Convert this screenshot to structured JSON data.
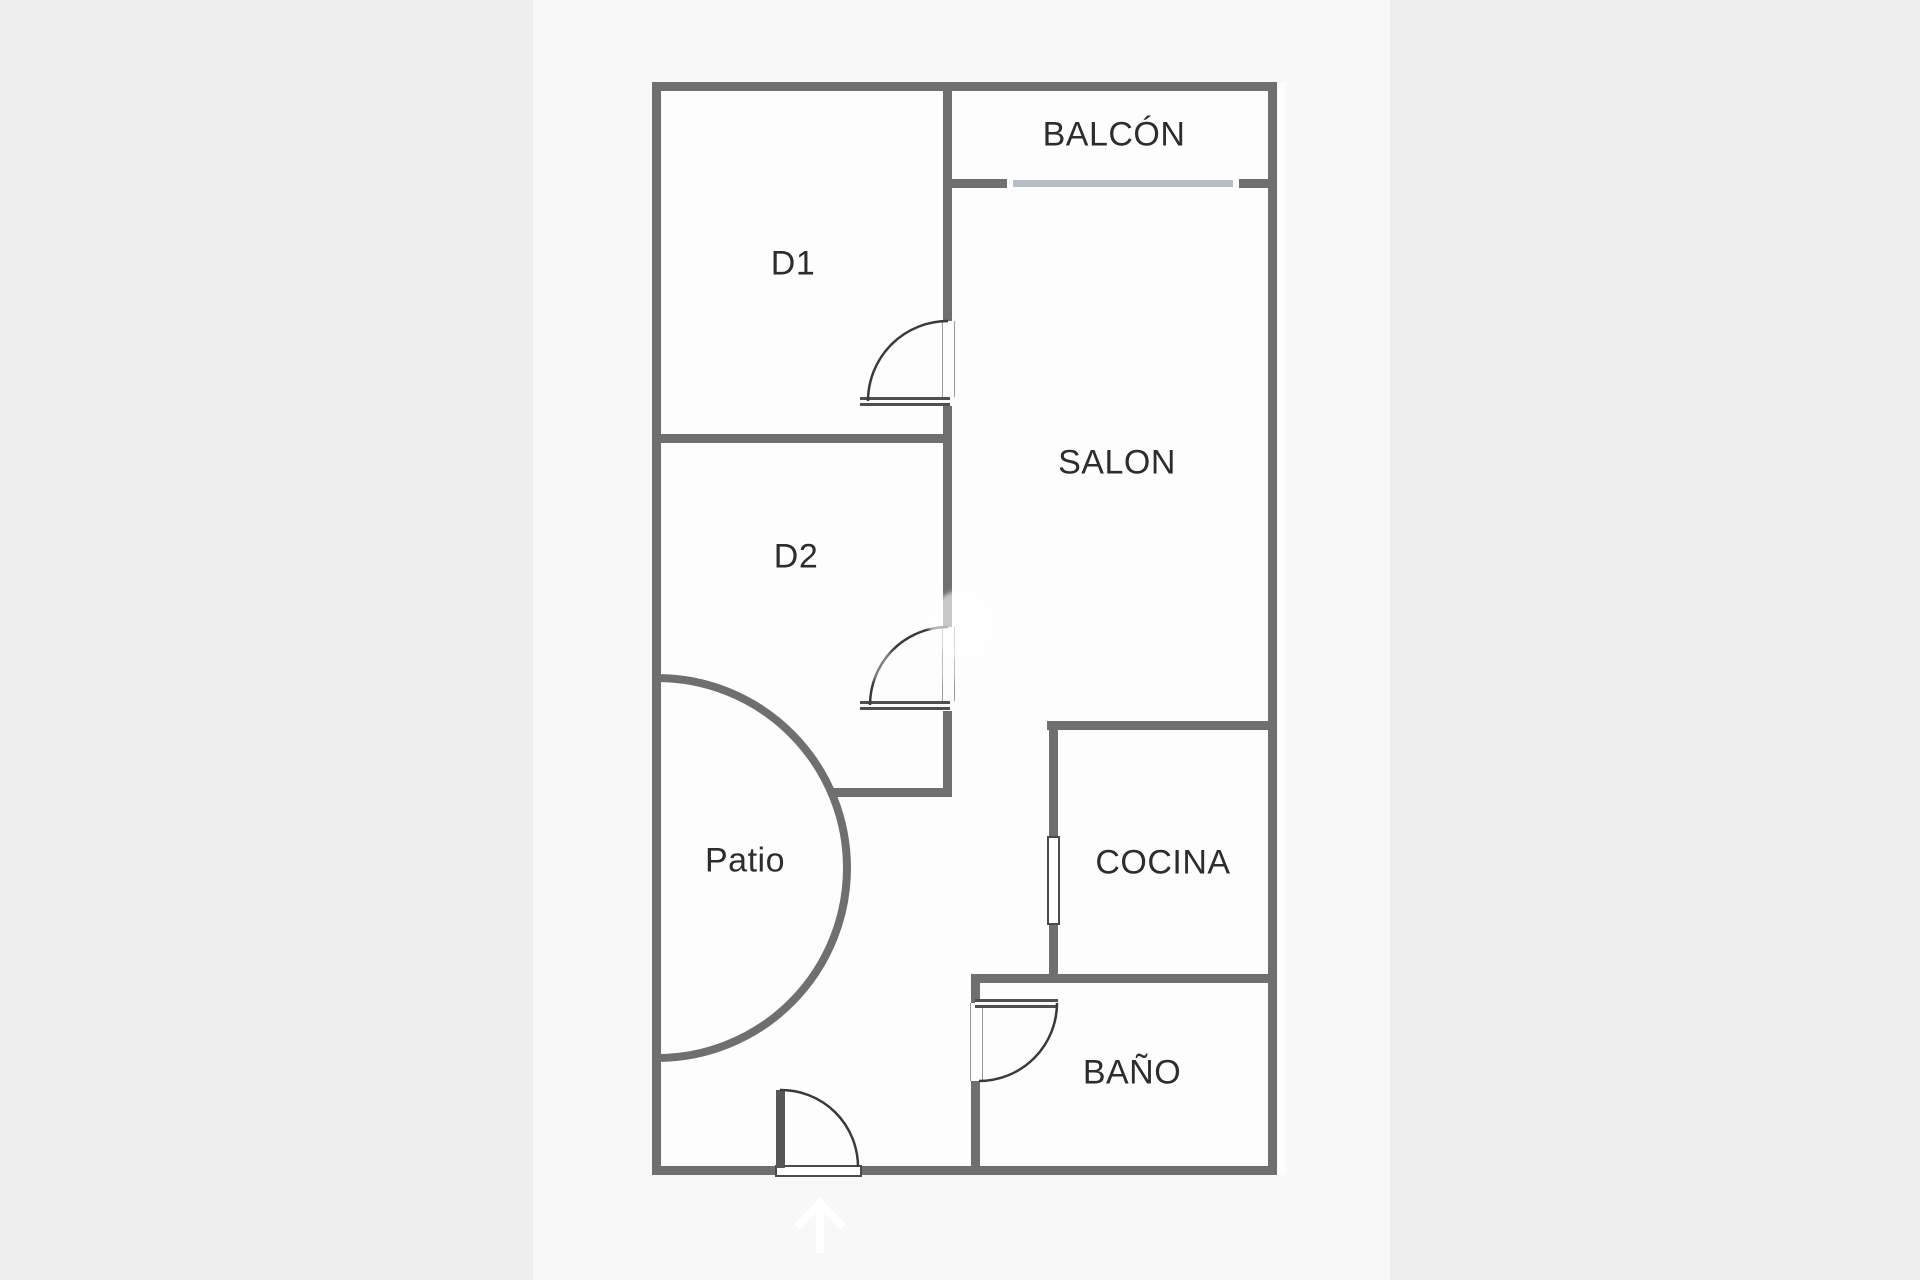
{
  "plan": {
    "rooms": {
      "balcon": {
        "label": "BALCÓN"
      },
      "d1": {
        "label": "D1"
      },
      "salon": {
        "label": "SALON"
      },
      "d2": {
        "label": "D2"
      },
      "patio": {
        "label": "Patio"
      },
      "cocina": {
        "label": "COCINA"
      },
      "bano": {
        "label": "BAÑO"
      }
    },
    "icons": {
      "entrance_arrow": "up-arrow-icon"
    },
    "colors": {
      "bg": "#eeeeee",
      "paper": "#f8f8f8",
      "room": "#fdfdfd",
      "wall": "#6f6f6f",
      "window": "#b6bdc4",
      "label": "#2d2d2d",
      "arc": "#3a3a3a",
      "arrow": "#ffffff"
    }
  }
}
